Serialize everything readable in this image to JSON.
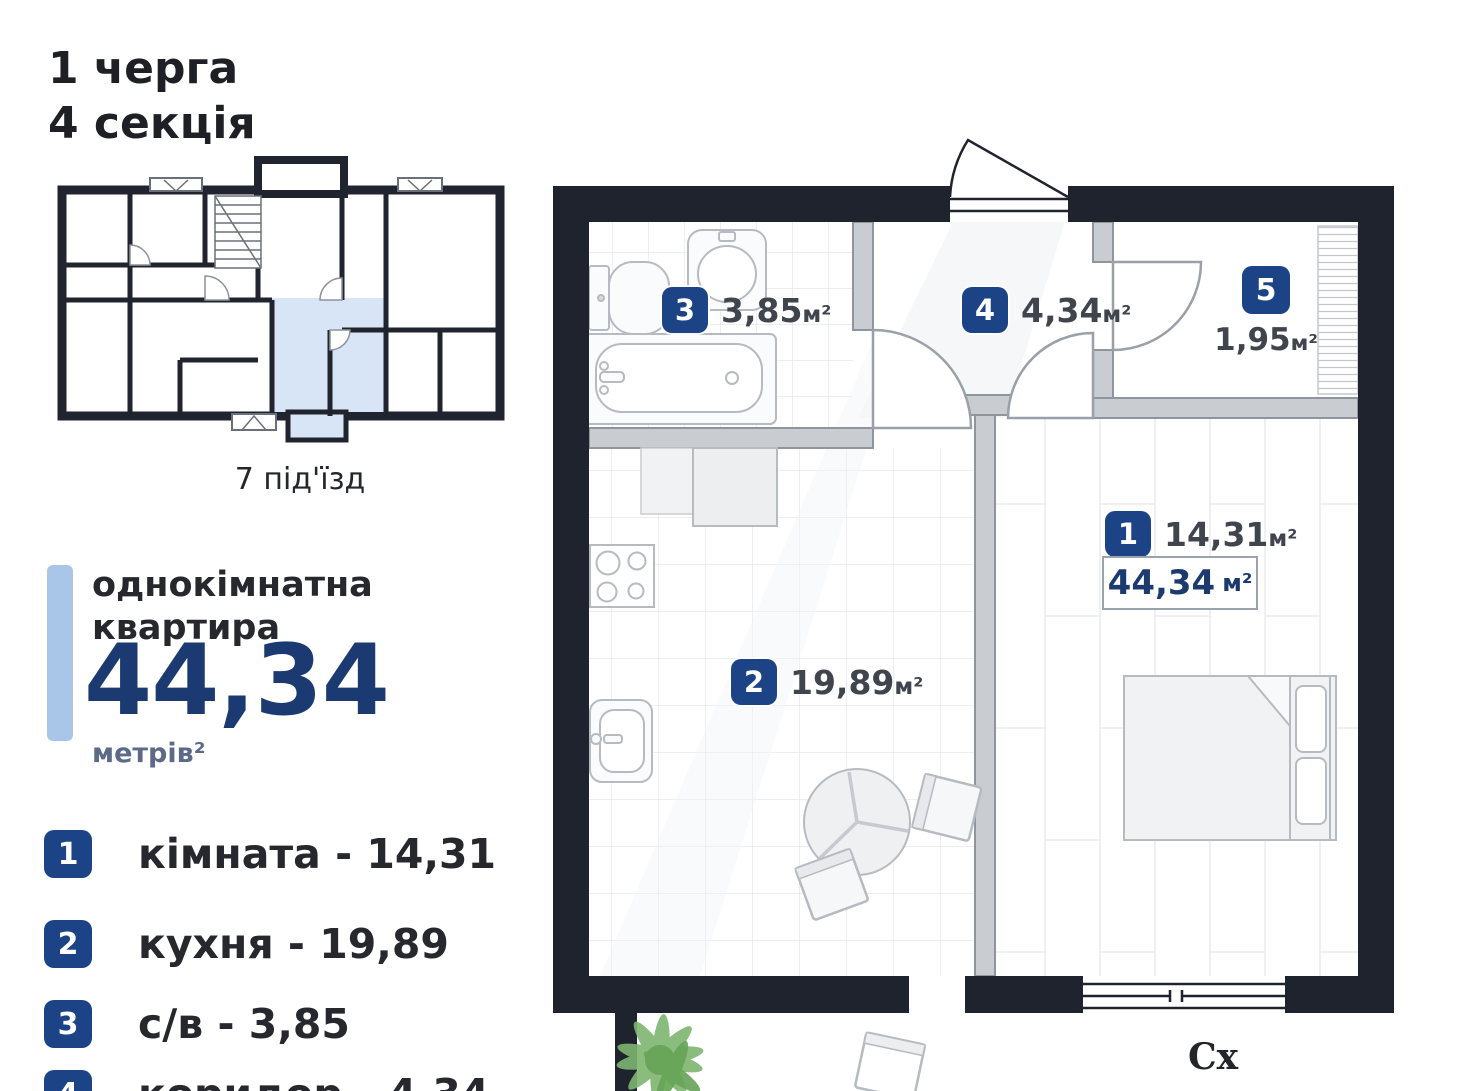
{
  "header": {
    "line1": "1 черга",
    "line2": "4 секція"
  },
  "mini_plan": {
    "caption": "7 під'їзд"
  },
  "summary": {
    "type_line1": "однокімнатна",
    "type_line2": "квартира",
    "area_value": "44,34",
    "area_unit": "метрів²"
  },
  "legend": {
    "items": [
      {
        "num": "1",
        "label": "кімната - 14,31"
      },
      {
        "num": "2",
        "label": "кухня - 19,89"
      },
      {
        "num": "3",
        "label": "с/в - 3,85"
      },
      {
        "num": "4",
        "label": "коридор - 4,34"
      }
    ]
  },
  "plan": {
    "rooms": [
      {
        "num": "1",
        "value": "14,31",
        "unit": "м²"
      },
      {
        "num": "2",
        "value": "19,89",
        "unit": "м²"
      },
      {
        "num": "3",
        "value": "3,85",
        "unit": "м²"
      },
      {
        "num": "4",
        "value": "4,34",
        "unit": "м²"
      },
      {
        "num": "5",
        "value": "1,95",
        "unit": "м²"
      }
    ],
    "total_value": "44,34",
    "total_unit": "м²",
    "compass_east": "Сх"
  },
  "colors": {
    "badge_blue": "#1c4386",
    "navy_text": "#1d3a6e",
    "wall_dark": "#1f232e",
    "accent_bar": "#a9c6e8",
    "highlight_unit": "#d8e5f6"
  }
}
